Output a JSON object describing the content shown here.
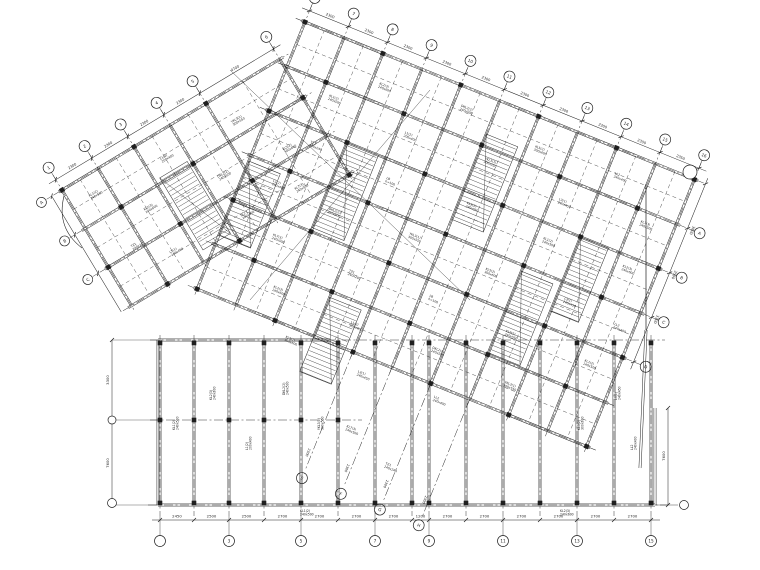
{
  "drawing": {
    "background": "#ffffff",
    "ink": "#1f1f1f",
    "systems": {
      "upper": {
        "angle": -31,
        "origin": [
          62,
          190
        ],
        "cols": [
          0,
          42,
          84,
          126,
          168,
          254
        ],
        "col_dims": [
          "2300",
          "2300",
          "2300",
          "2300",
          "4700"
        ],
        "rows": [
          0,
          45,
          90,
          135
        ],
        "top_bubbles": [
          "1",
          "2",
          "3",
          "4",
          "5",
          "6"
        ],
        "left_bubbles": [
          "A",
          "B",
          "C"
        ]
      },
      "main": {
        "angle": 22,
        "origin": [
          305,
          22
        ],
        "cols": [
          0,
          42,
          84,
          126,
          168,
          210,
          252,
          294,
          336,
          378,
          420
        ],
        "col_dims": [
          "2300",
          "2300",
          "2300",
          "2300",
          "2300",
          "2300",
          "2300",
          "2300",
          "2300",
          "2350"
        ],
        "rows": [
          0,
          48,
          96,
          144,
          192,
          240,
          288
        ],
        "right_ticks": [
          0,
          48,
          96,
          144,
          192
        ],
        "right_dims": [
          "3600",
          "3500",
          "3300"
        ],
        "right_bubbles": [
          "A",
          "B",
          "C",
          "D"
        ],
        "top_bubbles": [
          "6",
          "7",
          "8",
          "9",
          "10",
          "11",
          "12",
          "13",
          "14",
          "15",
          "16"
        ],
        "dangle_cols": [
          168,
          210,
          252,
          294
        ],
        "dangle_bubbles": [
          "E",
          "F",
          "G",
          "H"
        ],
        "dangle_dim": "2300"
      }
    },
    "lower": {
      "axes": [
        160,
        194,
        229,
        264,
        301,
        338,
        375,
        412,
        429,
        466,
        503,
        540,
        577,
        614,
        651
      ],
      "axis_dims": [
        "2450",
        "2500",
        "2500",
        "2700",
        "2700",
        "2700",
        "2700",
        "1200",
        "2700",
        "2700",
        "2700",
        "2700",
        "2700",
        "2700"
      ],
      "bubble_axes": [
        0,
        2,
        4,
        6,
        8,
        10,
        12,
        14
      ],
      "bubble_labels": [
        "1",
        "3",
        "5",
        "7",
        "9",
        "11",
        "13",
        "15"
      ],
      "top_y": 340,
      "bot_y": 505,
      "dim_y": 520,
      "bubble_y": 541,
      "left_dims": [
        "3300",
        "7600"
      ],
      "right_dim": "7600"
    },
    "hatches": {
      "main": [
        [
          84,
          96,
          34,
          92
        ],
        [
          210,
          36,
          34,
          92
        ],
        [
          294,
          150,
          34,
          88
        ],
        [
          126,
          246,
          34,
          80
        ],
        [
          0,
          150,
          34,
          80
        ],
        [
          336,
          96,
          30,
          80
        ]
      ],
      "upper": [
        [
          90,
          40,
          32,
          84
        ]
      ]
    },
    "annotations": {
      "pool": [
        [
          "KL1(2)",
          "240x500"
        ],
        [
          "KL2(3)",
          "240x600"
        ],
        [
          "L1(2)",
          "200x400"
        ],
        [
          "DKL2(2)",
          "240x500"
        ],
        [
          "YKL3(1)",
          "300x550"
        ],
        [
          "KL5(2)",
          "300x600"
        ],
        [
          "L3(1)",
          "240x450"
        ],
        [
          "LL2",
          "240x400"
        ],
        [
          "KL7(3)",
          "240x500"
        ],
        [
          "TZ1",
          "240x240"
        ],
        [
          "LB",
          "h=100"
        ],
        [
          "KL9(2)",
          "240x550"
        ]
      ],
      "main_pos": [
        [
          50,
          60
        ],
        [
          92,
          30
        ],
        [
          134,
          66
        ],
        [
          176,
          20
        ],
        [
          218,
          60
        ],
        [
          260,
          30
        ],
        [
          302,
          70
        ],
        [
          344,
          25
        ],
        [
          386,
          60
        ],
        [
          50,
          110
        ],
        [
          134,
          115
        ],
        [
          218,
          108
        ],
        [
          302,
          112
        ],
        [
          386,
          108
        ],
        [
          30,
          160
        ],
        [
          92,
          165
        ],
        [
          176,
          158
        ],
        [
          260,
          162
        ],
        [
          344,
          160
        ],
        [
          400,
          165
        ],
        [
          50,
          210
        ],
        [
          134,
          215
        ],
        [
          218,
          208
        ],
        [
          302,
          212
        ],
        [
          386,
          210
        ],
        [
          70,
          258
        ],
        [
          155,
          262
        ],
        [
          240,
          255
        ],
        [
          320,
          260
        ],
        [
          100,
          300
        ],
        [
          180,
          305
        ],
        [
          260,
          300
        ],
        [
          190,
          360
        ],
        [
          240,
          380
        ]
      ],
      "upper_pos": [
        [
          20,
          20
        ],
        [
          60,
          60
        ],
        [
          100,
          25
        ],
        [
          140,
          70
        ],
        [
          180,
          30
        ],
        [
          210,
          80
        ],
        [
          60,
          110
        ],
        [
          140,
          115
        ],
        [
          200,
          120
        ],
        [
          30,
          85
        ]
      ],
      "lower_pos_v": [
        [
          175,
          430
        ],
        [
          212,
          400
        ],
        [
          248,
          450
        ],
        [
          285,
          395
        ],
        [
          320,
          430
        ],
        [
          580,
          430
        ],
        [
          617,
          400
        ],
        [
          633,
          450
        ]
      ],
      "lower_pos_h": [
        [
          300,
          512
        ],
        [
          560,
          512
        ]
      ]
    }
  }
}
